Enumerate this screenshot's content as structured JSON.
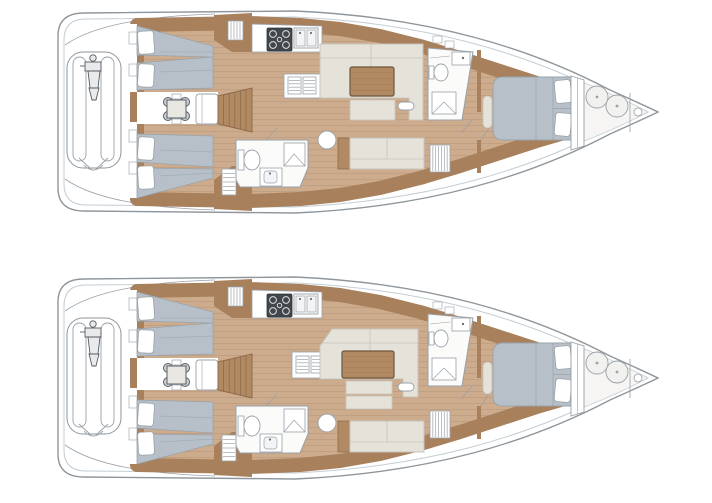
{
  "page": {
    "description": "Two sailing-yacht interior layout plans (bow pointing right) stacked vertically for comparison",
    "background": "#ffffff"
  },
  "colors": {
    "hull-stroke": "#8f969b",
    "hull-inner": "#c3ced4",
    "wood-band": "#a8805c",
    "wood-line": "#8f6b49",
    "floor": "#cdac8e",
    "floor-line": "#b8977a",
    "wood-mid": "#b18a63",
    "berth": "#b7c0c8",
    "berth-line": "#97a3ad",
    "settee": "#e5e2da",
    "settee-line": "#c8c5bb",
    "white": "#ffffff",
    "fixture": "#9aa1a6",
    "stove": "#42474c",
    "paper": "#f4f3f1"
  },
  "boats": [
    {
      "name": "layout-plan-top",
      "variant": "A",
      "areas": [
        "transom-garage-with-tender",
        "aft-cabin-port-twin-berths",
        "aft-cabin-starboard-twin-berths",
        "crew-mess-table",
        "companionway-stairs",
        "galley",
        "saloon-dinette-high",
        "saloon-sofa",
        "day-head-with-shower",
        "forward-head",
        "owner-cabin-island-berth",
        "sail-locker"
      ]
    },
    {
      "name": "layout-plan-bottom",
      "variant": "B",
      "areas": [
        "transom-garage-with-tender",
        "aft-cabin-port-twin-berths",
        "aft-cabin-starboard-twin-berths",
        "crew-mess-table",
        "companionway-stairs",
        "galley",
        "saloon-dinette-low-angled",
        "saloon-sofa",
        "day-head-with-shower",
        "forward-head",
        "owner-cabin-island-berth",
        "sail-locker"
      ]
    }
  ]
}
